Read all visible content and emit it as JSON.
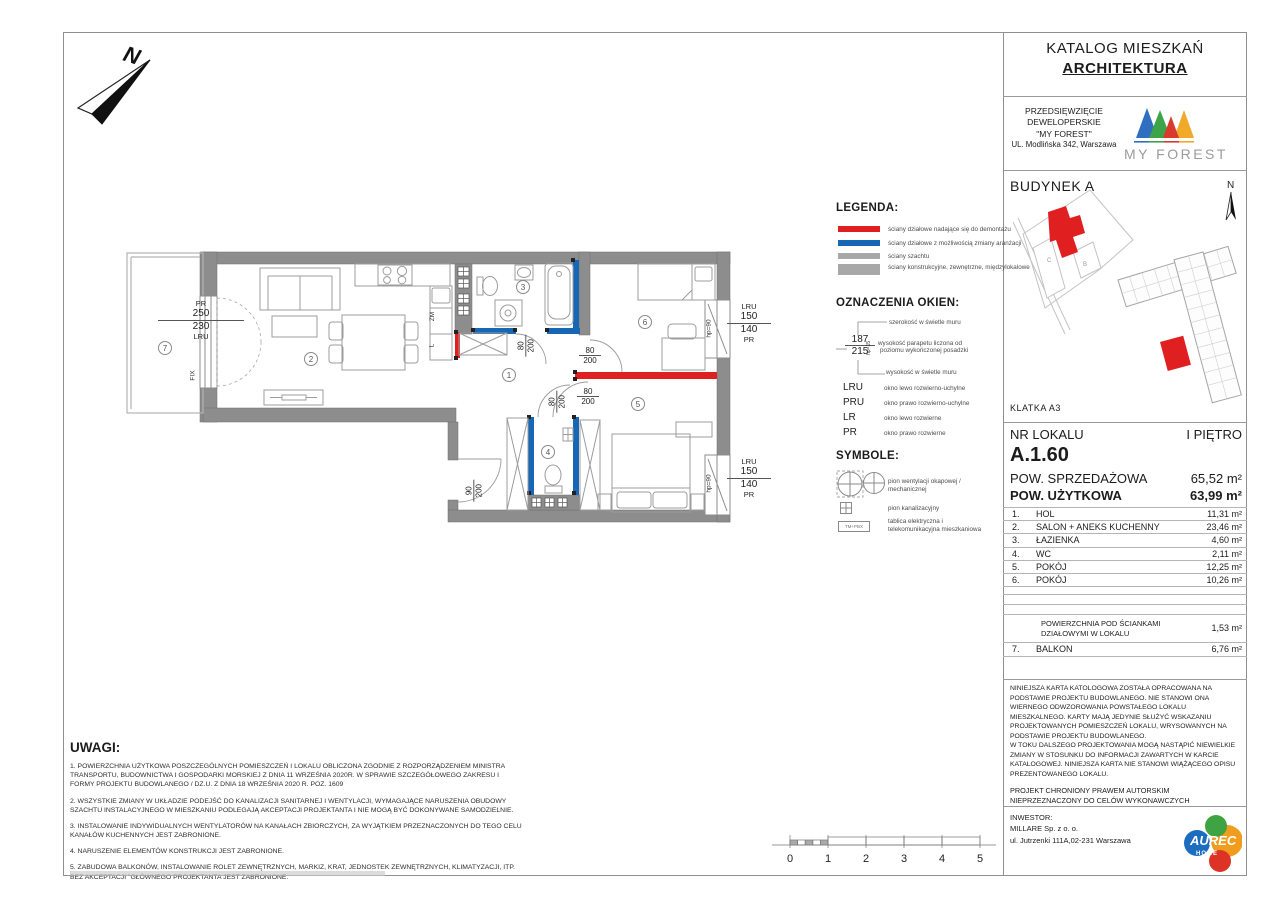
{
  "header": {
    "title": "KATALOG MIESZKAŃ",
    "subtitle": "ARCHITEKTURA"
  },
  "developer": {
    "line1": "PRZEDSIĘWZIĘCIE",
    "line2": "DEWELOPERSKIE",
    "line3": "\"MY FOREST\"",
    "line4": "UL. Modlińska 342, Warszawa",
    "logo_text": "MY FOREST"
  },
  "site": {
    "building_label": "BUDYNEK A",
    "klatka": "KLATKA  A3",
    "north": "N",
    "b": "B",
    "c": "C"
  },
  "compass_n": "N",
  "unit": {
    "label": "NR LOKALU",
    "floor": "I PIĘTRO",
    "number": "A.1.60",
    "sales_label": "POW. SPRZEDAŻOWA",
    "sales_value": "65,52 m²",
    "usable_label": "POW. UŻYTKOWA",
    "usable_value": "63,99 m²"
  },
  "rooms": [
    {
      "no": "1.",
      "name": "HOL",
      "area": "11,31 m²"
    },
    {
      "no": "2.",
      "name": "SALON + ANEKS KUCHENNY",
      "area": "23,46 m²"
    },
    {
      "no": "3.",
      "name": "ŁAZIENKA",
      "area": "4,60 m²"
    },
    {
      "no": "4.",
      "name": "WC",
      "area": "2,11 m²"
    },
    {
      "no": "5.",
      "name": "POKÓJ",
      "area": "12,25 m²"
    },
    {
      "no": "6.",
      "name": "POKÓJ",
      "area": "10,26 m²"
    }
  ],
  "partition": {
    "line1": "POWIERZCHNIA  POD ŚCIANKAMI",
    "line2": "DZIAŁOWYMI W LOKALU",
    "area": "1,53 m²"
  },
  "balcony_row": {
    "no": "7.",
    "name": "BALKON",
    "area": "6,76 m²"
  },
  "legend": {
    "title": "LEGENDA:",
    "items": [
      {
        "color": "#e02020",
        "label": "ściany działowe nadające się do demontażu"
      },
      {
        "color": "#1867b4",
        "label": "ściany działowe z możliwością zmiany aranżacji"
      },
      {
        "color": "#a8a8a8",
        "label": "ściany szachtu"
      },
      {
        "color": "#a8a8a8",
        "label": "ściany konstrukcyjne, zewnętrzne, międzylokalowe"
      }
    ]
  },
  "windows_legend": {
    "title": "OZNACZENIA OKIEN:",
    "example_top": "187",
    "example_bottom": "215",
    "example_side": "hp=15",
    "width_label": "szerokość w świetle muru",
    "sill_label1": "wysokość parapetu liczona od",
    "sill_label2": "poziomu wykończonej posadzki",
    "height_label": "wysokość w świetle muru",
    "abbr": [
      {
        "code": "LRU",
        "desc": "okno lewo rozwierno-uchylne"
      },
      {
        "code": "PRU",
        "desc": "okno prawo rozwierno-uchylne"
      },
      {
        "code": "LR",
        "desc": "okno lewo rozwierne"
      },
      {
        "code": "PR",
        "desc": "okno prawo rozwierne"
      }
    ]
  },
  "symbols": {
    "title": "SYMBOLE:",
    "vent_label": "pion wentylacji okapowej / mechanicznej",
    "sewage_label": "pion kanalizacyjny",
    "board_label1": "tablica elektryczna i",
    "board_label2": "telekomunikacyjna mieszkaniowa",
    "board_text": "TM+PBX"
  },
  "uwagi": {
    "title": "UWAGI:",
    "notes": [
      "1. POWIERZCHNIA UŻYTKOWA POSZCZEGÓLNYCH POMIESZCZEŃ I LOKALU OBLICZONA ZGODNIE Z ROZPORZĄDZENIEM MINISTRA TRANSPORTU, BUDOWNICTWA I GOSPODARKI MORSKIEJ Z DNIA 11 WRZEŚNIA 2020R. W SPRAWIE SZCZEGÓŁOWEGO ZAKRESU I FORMY PROJEKTU BUDOWLANEGO / DZ.U. Z DNIA 18 WRZEŚNIA 2020 R. POZ. 1609",
      "2. WSZYSTKIE ZMIANY W UKŁADZIE PODEJŚĆ DO KANALIZACJI SANITARNEJ I WENTYLACJI, WYMAGAJĄCE NARUSZENIA OBUDOWY SZACHTU INSTALACYJNEGO W MIESZKANIU PODLEGAJĄ AKCEPTACJI PROJEKTANTA I NIE MOGĄ BYĆ DOKONYWANE SAMODZIELNIE.",
      "3. INSTALOWANIE INDYWIDUALNYCH WENTYLATORÓW NA KANAŁACH ZBIORCZYCH, ZA WYJĄTKIEM PRZEZNACZONYCH DO TEGO CELU KANAŁÓW KUCHENNYCH JEST ZABRONIONE.",
      "4. NARUSZENIE ELEMENTÓW KONSTRUKCJI JEST ZABRONIONE.",
      "5. ZABUDOWA BALKONÓW, INSTALOWANIE ROLET ZEWNĘTRZNYCH, MARKIZ, KRAT, JEDNOSTEK ZEWNĘTRZNYCH, KLIMATYZACJI, ITP. BEZ AKCEPTACJI \"GŁÓWNEGO PROJEKTANTA JEST ZABRONIONE."
    ]
  },
  "disclaimer": {
    "p1": "NINIEJSZA KARTA KATOLOGOWA ZOSTAŁA OPRACOWANA NA PODSTAWIE PROJEKTU BUDOWLANEGO. NIE STANOWI ONA WIERNEGO ODWZOROWANIA POWSTAŁEGO LOKALU MIESZKALNEGO. KARTY MAJĄ JEDYNIE SŁUŻYĆ WSKAZANIU PROJEKTOWANYCH POMIESZCZEŃ LOKALU, WRYSOWANYCH NA PODSTAWIE PROJEKTU BUDOWLANEGO.",
    "p2": "W TOKU DALSZEGO PROJEKTOWANIA MOGĄ NASTĄPIĆ NIEWIELKIE ZMIANY W STOSUNKU DO INFORMACJI ZAWARTYCH W KARCIE KATALOGOWEJ. NINIEJSZA KARTA NIE STANOWI WIĄŻĄCEGO OPISU PREZENTOWANEGO LOKALU.",
    "copyright1": "PROJEKT CHRONIONY PRAWEM AUTORSKIM",
    "copyright2": "NIEPRZEZNACZONY DO CELÓW WYKONAWCZYCH"
  },
  "investor": {
    "label": "INWESTOR:",
    "name": "MILLARE Sp. z o. o.",
    "address": "ul. Jutrzenki 111A,02-231 Warszawa",
    "logo_line1": "AUREC",
    "logo_line2": "HOME"
  },
  "plan": {
    "circles": [
      "1",
      "2",
      "3",
      "4",
      "5",
      "6",
      "7"
    ],
    "left_window": {
      "pr": "PR",
      "top": "250",
      "bottom": "230",
      "lru": "LRU"
    },
    "fix": "FIX",
    "zm": "ZM",
    "l": "L",
    "win_top": {
      "a": "LRU",
      "b": "150",
      "c": "140",
      "d": "PR"
    },
    "win_bottom": {
      "a": "LRU",
      "b": "150",
      "c": "140",
      "d": "PR"
    },
    "hp90": "hp=90",
    "door80": {
      "w": "80",
      "h": "200"
    },
    "door90": {
      "w": "90",
      "h": "200"
    }
  },
  "scalebar": {
    "labels": [
      "0",
      "1",
      "2",
      "3",
      "4",
      "5"
    ]
  },
  "colors": {
    "wall": "#8d8d8d",
    "red": "#e02020",
    "blue": "#1867b4"
  }
}
